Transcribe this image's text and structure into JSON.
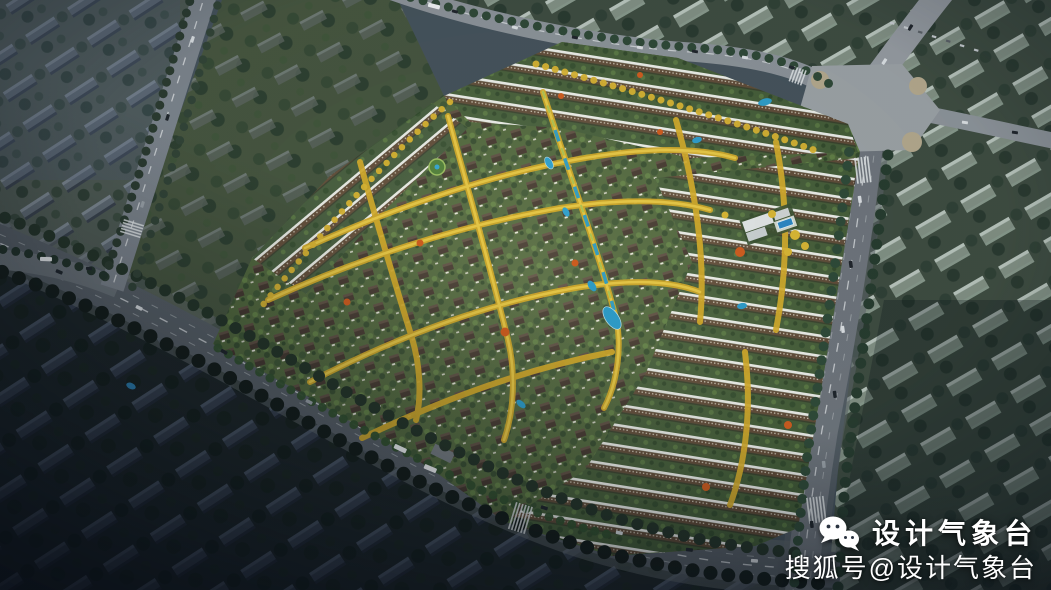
{
  "scene": {
    "description": "Dusk aerial rendering of a low-rise residential community master plan, bright development in the center surrounded by darker city context and arterial roads",
    "regions": {
      "development_parcel": "central community of villa rows and brown apartment slabs with white roofs",
      "tree_avenues": "golden autumn tree-lined internal streets in a grid",
      "water_axis": "central blue landscape water axis with ponds",
      "clubhouse_pool": "white clubhouse pavilions with blue swimming pool, east side",
      "context_top_left": "existing grey city blocks, slightly blurred",
      "context_bottom_left": "dark unlit city blocks and trees",
      "context_right": "translucent ghosted massing buildings",
      "main_intersection": "large light-grey road intersection, top right",
      "boulevard_south": "wide multi-lane boulevard with buses along the south-west edge",
      "road_east": "arterial road along the east edge",
      "road_north": "road along the north edge",
      "road_northwest": "diagonal road, upper left"
    }
  },
  "watermark": {
    "icon": "wechat-icon",
    "line1": "设计气象台",
    "line2": "搜狐号@设计气象台",
    "text_color": "#ffffff"
  },
  "palette": {
    "context_dark": "#1d2628",
    "context_grey": "#606b74",
    "ghost_building": "#c2d1c6",
    "road_asphalt": "#575f66",
    "road_plaza": "#9aa0a4",
    "villa_roof": "#3f332b",
    "apartment_facade": "#5c4835",
    "apartment_roof": "#e9ebe7",
    "tree_green": "#3f5a35",
    "tree_yellow": "#d6b233",
    "tree_orange": "#cd5d20",
    "water": "#2f9cc7"
  }
}
